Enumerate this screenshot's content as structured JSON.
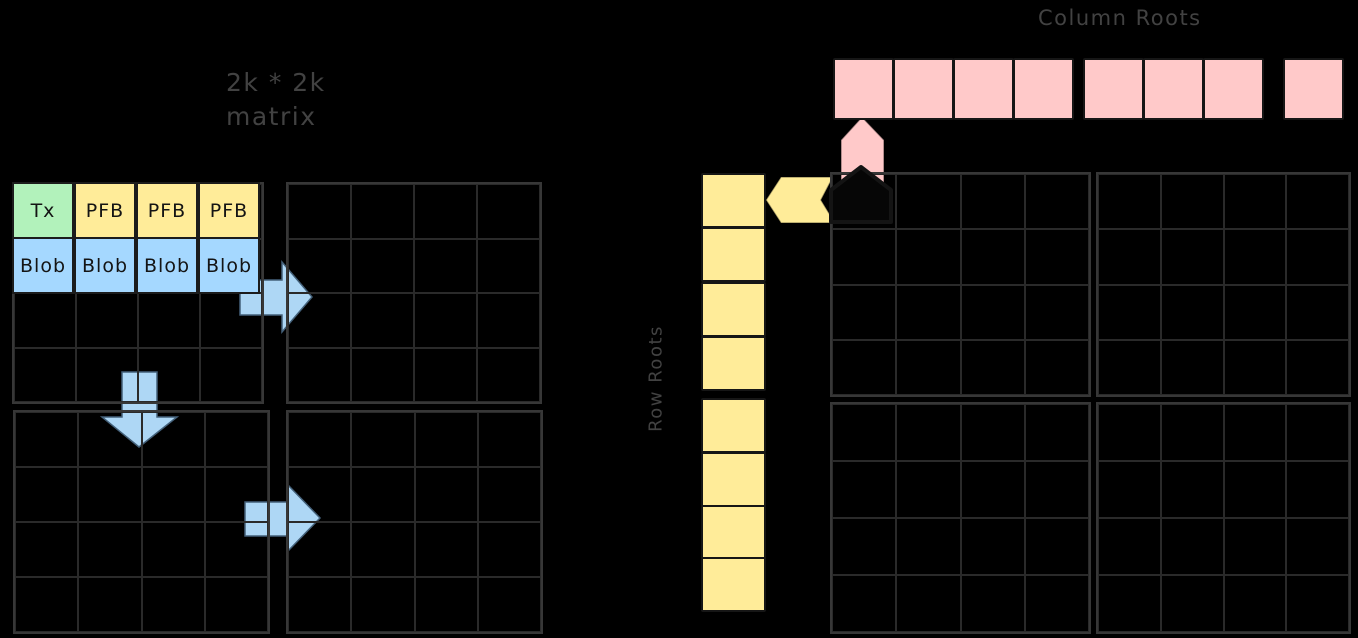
{
  "diagram": {
    "background": "#000000",
    "labels": {
      "matrix_size_line1": "2k * 2k",
      "matrix_size_line2": "matrix",
      "column_roots": "Column Roots",
      "row_roots": "Row Roots"
    },
    "left_matrix": {
      "description": "2k * 2k matrix split into 4 quadrant grids of 4x4 tiles",
      "quadrant_count": 4,
      "grid_rows": 4,
      "grid_cols": 4,
      "tile_row": {
        "cells": [
          {
            "label": "Tx",
            "color": "#b2f2bb"
          },
          {
            "label": "PFB",
            "color": "#ffec99"
          },
          {
            "label": "PFB",
            "color": "#ffec99"
          },
          {
            "label": "PFB",
            "color": "#ffec99"
          }
        ]
      },
      "blob_row": {
        "cells": [
          {
            "label": "Blob",
            "color": "#a5d8ff"
          },
          {
            "label": "Blob",
            "color": "#a5d8ff"
          },
          {
            "label": "Blob",
            "color": "#a5d8ff"
          },
          {
            "label": "Blob",
            "color": "#a5d8ff"
          }
        ]
      }
    },
    "right_matrix": {
      "description": "2k * 2k matrix split into 4 quadrant grids of 4x4 tiles",
      "quadrant_count": 4,
      "grid_rows": 4,
      "grid_cols": 4
    },
    "column_roots": {
      "count": 8,
      "color": "#ffc9c9"
    },
    "row_roots": {
      "count": 8,
      "color": "#ffec99"
    },
    "arrows": {
      "flow_color": "#aed7f5",
      "flow_stroke": "#44617a",
      "up_arrow_color": "#ffc9c9",
      "left_arrow_color": "#ffec99",
      "corner_marker_color": "#060606"
    },
    "colors": {
      "grid_line": "#2a2a2a",
      "grid_border": "#373737",
      "label_text": "#424242",
      "cell_text": "#141414"
    }
  }
}
